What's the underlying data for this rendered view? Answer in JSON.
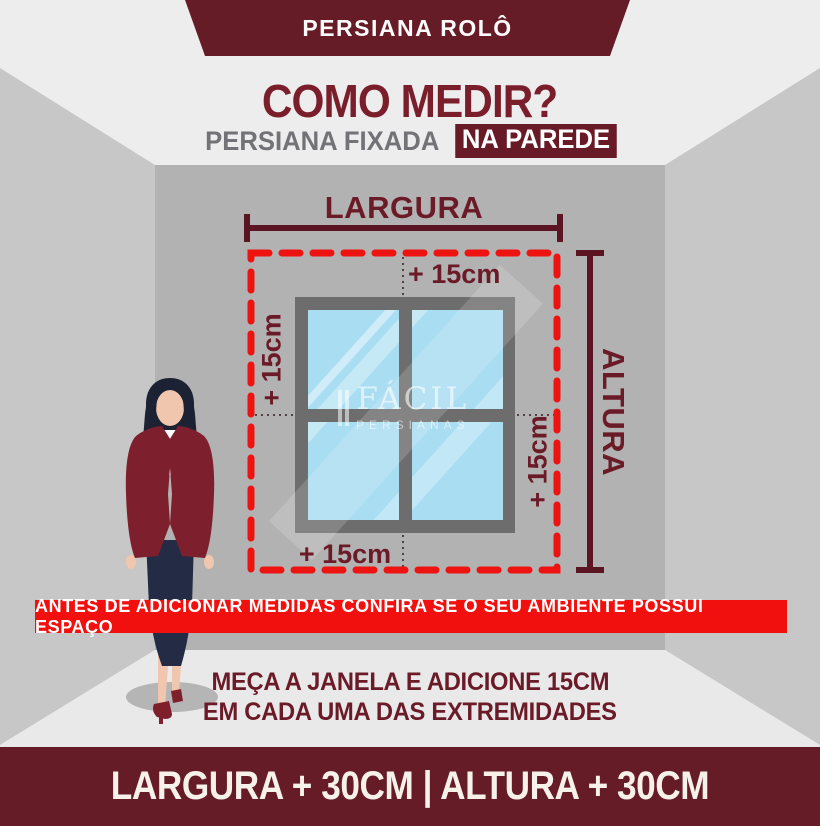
{
  "header": {
    "banner_title": "PERSIANA ROLÔ",
    "title": "COMO MEDIR?",
    "subtitle_plain": "PERSIANA FIXADA",
    "subtitle_highlight": "NA PAREDE"
  },
  "diagram": {
    "width_label": "LARGURA",
    "height_label": "ALTURA",
    "offset_top": "+ 15cm",
    "offset_right": "+ 15cm",
    "offset_bottom": "+ 15cm",
    "offset_left": "+ 15cm",
    "watermark_line1": "FÁCIL",
    "watermark_line2": "PERSIANAS"
  },
  "notice": {
    "warning": "ANTES DE ADICIONAR MEDIDAS CONFIRA SE O SEU AMBIENTE POSSUI ESPAÇO",
    "instruction_line1": "MEÇA A JANELA E ADICIONE 15CM",
    "instruction_line2": "EM CADA UMA DAS EXTREMIDADES"
  },
  "footer": {
    "formula": "LARGURA + 30CM | ALTURA + 30CM"
  },
  "colors": {
    "maroon_banner": "#661c27",
    "maroon_text": "#6b1a27",
    "title_maroon": "#7a1e2c",
    "subtitle_gray": "#737377",
    "alert_red": "#f2100e",
    "dash_red": "#ed1310",
    "measure_line": "#5a1422",
    "wall_back": "#b2b2b2",
    "wall_side": "#c7c7c7",
    "floor": "#e9e9e9",
    "ceiling": "#ededed",
    "window_frame": "#6d6d6d",
    "glass_blue": "#a8ddf2",
    "blazer_maroon": "#7e1f2d",
    "hair_navy": "#1c2233",
    "skirt_navy": "#232c44",
    "skin": "#f0c6ae"
  }
}
